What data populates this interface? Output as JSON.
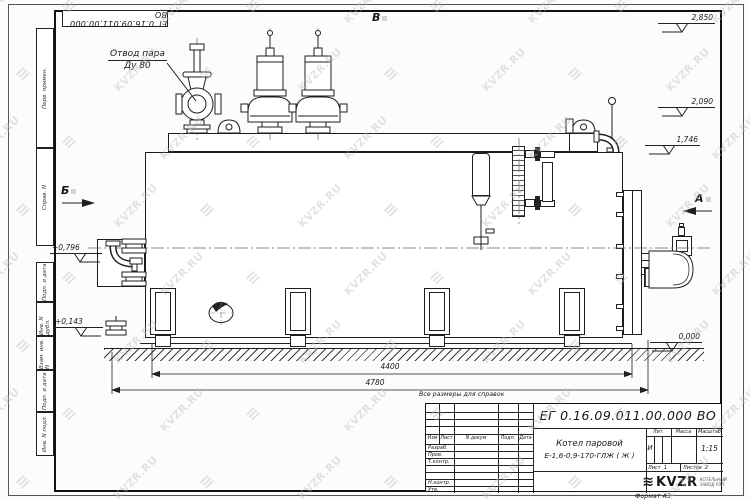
{
  "sheet": {
    "stamp_top_left": "ЕГ 0.16.09.011.00.000  ВО",
    "format_note": "Формат А3",
    "reference_note": "Все размеры для справок",
    "watermark": {
      "text": "KVZR.RU",
      "glyph": "≡",
      "color": "#bcbcbc"
    },
    "margin_cells_top": [
      "Перв. примен.",
      "Справ. N"
    ],
    "margin_cells_bottom": [
      "Подп. и дата",
      "Инв. N дубл.",
      "Взам. инв. N",
      "Подп. и дата",
      "Инв. N подл."
    ]
  },
  "drawing": {
    "callout_line1": "Отвод пара",
    "callout_line2": "Ду 80",
    "view_label_top": "В",
    "view_label_left": "Б",
    "view_label_right": "А",
    "elevations": {
      "e2850": "2,850",
      "e2090": "2,090",
      "e1746": "1,746",
      "e0796": "+0,796",
      "e0143": "+0,143",
      "e0000": "0,000"
    },
    "dim_overall_1": "4400",
    "dim_overall_2": "4780"
  },
  "title_block": {
    "doc_number": "ЕГ 0.16.09.011.00.000  ВО",
    "product_line1": "Котел паровой",
    "product_line2": "Е-1,6-0,9-170-ГЛЖ ( Ж )",
    "col_izm": "Изм",
    "col_list": "Лист",
    "col_ndokum": "N докум",
    "col_podp": "Подп.",
    "col_data": "Дата",
    "row_razrab": "Разраб.",
    "row_prov": "Пров.",
    "row_tkontr": "Т.контр.",
    "row_nkontr": "Н.контр.",
    "row_utv": "Утв.",
    "lit_label": "Лит.",
    "lit_value": "И",
    "mass_label": "Масса",
    "scale_label": "Масштаб",
    "scale_value": "1:15",
    "sheet_word": "Лист",
    "sheet_num": "1",
    "sheets_word": "Листов",
    "sheets_num": "2",
    "logo_glyph": "≋",
    "logo_text": "KVZR",
    "company_line1": "КОТЕЛЬНЫЙ",
    "company_line2": "ЗАВОД РЭП"
  }
}
